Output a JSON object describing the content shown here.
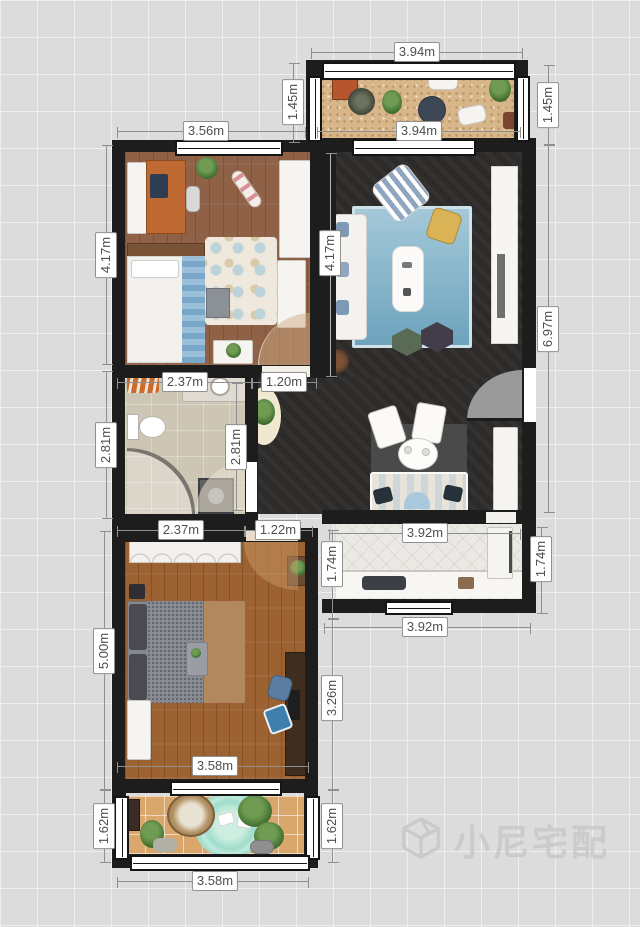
{
  "watermark": {
    "brand": "小尼宅配",
    "logo_icon": "cube-logo-icon"
  },
  "units": "m",
  "palette": {
    "background": "#dcdcdc",
    "wall": "#1d1d1d",
    "living_floor": "#2d2b29",
    "bedroom1_floor": "#8f6147",
    "bedroom2_floor": "#9d6231",
    "bathroom_floor": "#cec6b4",
    "kitchen_floor": "#ebe9e4",
    "balcony_top_floor": "#d7b68a",
    "balcony_bottom_floor": "#d9a76c",
    "dimension_label_bg": "#ffffff",
    "dimension_text": "#4e4e4e"
  },
  "dimensions": [
    {
      "text": "3.94m",
      "x": 417,
      "y": 52,
      "vertical": false
    },
    {
      "text": "1.45m",
      "x": 293,
      "y": 102,
      "vertical": true
    },
    {
      "text": "1.45m",
      "x": 548,
      "y": 105,
      "vertical": true
    },
    {
      "text": "3.56m",
      "x": 206,
      "y": 131,
      "vertical": false
    },
    {
      "text": "3.94m",
      "x": 419,
      "y": 131,
      "vertical": false
    },
    {
      "text": "4.17m",
      "x": 106,
      "y": 255,
      "vertical": true
    },
    {
      "text": "4.17m",
      "x": 330,
      "y": 253,
      "vertical": true
    },
    {
      "text": "6.97m",
      "x": 548,
      "y": 329,
      "vertical": true
    },
    {
      "text": "2.37m",
      "x": 185,
      "y": 382,
      "vertical": false
    },
    {
      "text": "1.20m",
      "x": 284,
      "y": 382,
      "vertical": false
    },
    {
      "text": "2.81m",
      "x": 106,
      "y": 445,
      "vertical": true
    },
    {
      "text": "2.81m",
      "x": 236,
      "y": 447,
      "vertical": true
    },
    {
      "text": "2.37m",
      "x": 181,
      "y": 530,
      "vertical": false
    },
    {
      "text": "1.22m",
      "x": 278,
      "y": 530,
      "vertical": false
    },
    {
      "text": "3.92m",
      "x": 425,
      "y": 533,
      "vertical": false
    },
    {
      "text": "1.74m",
      "x": 332,
      "y": 564,
      "vertical": true
    },
    {
      "text": "1.74m",
      "x": 541,
      "y": 559,
      "vertical": true
    },
    {
      "text": "3.92m",
      "x": 425,
      "y": 627,
      "vertical": false
    },
    {
      "text": "5.00m",
      "x": 104,
      "y": 651,
      "vertical": true
    },
    {
      "text": "3.26m",
      "x": 332,
      "y": 698,
      "vertical": true
    },
    {
      "text": "3.58m",
      "x": 215,
      "y": 766,
      "vertical": false
    },
    {
      "text": "1.62m",
      "x": 104,
      "y": 826,
      "vertical": true
    },
    {
      "text": "1.62m",
      "x": 332,
      "y": 826,
      "vertical": true
    },
    {
      "text": "3.58m",
      "x": 215,
      "y": 881,
      "vertical": false
    }
  ]
}
